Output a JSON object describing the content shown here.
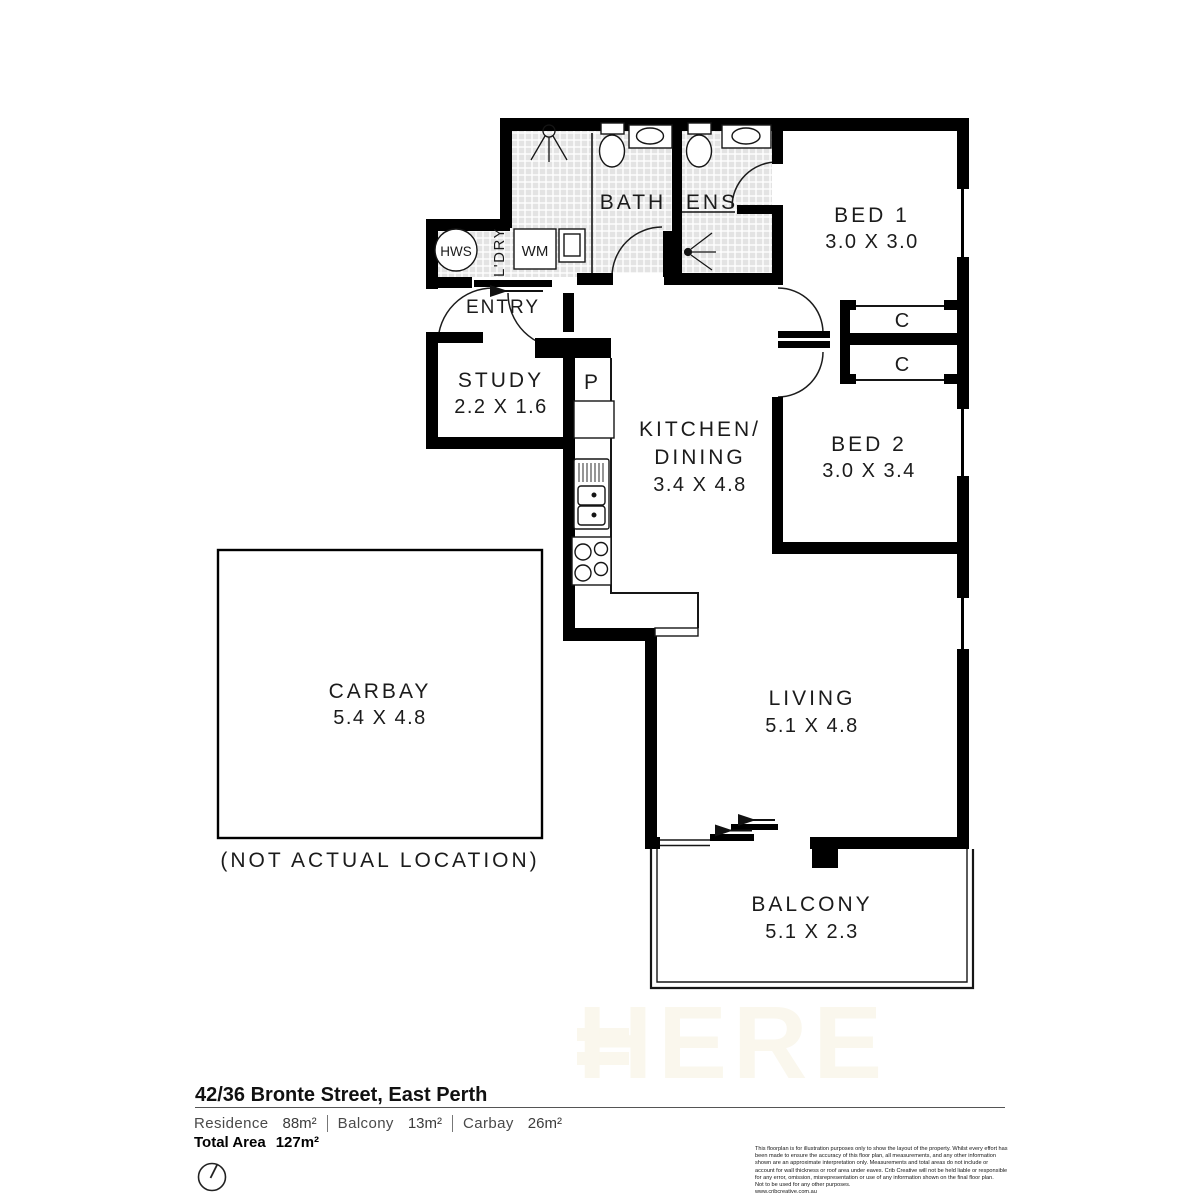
{
  "watermark": "HERE",
  "rooms": {
    "bath": {
      "label": "BATH"
    },
    "ens": {
      "label": "ENS"
    },
    "bed1": {
      "label": "BED 1",
      "dims": "3.0 X 3.0"
    },
    "bed2": {
      "label": "BED 2",
      "dims": "3.0 X 3.4"
    },
    "study": {
      "label": "STUDY",
      "dims": "2.2 X 1.6"
    },
    "kitchen": {
      "label": "KITCHEN/",
      "label2": "DINING",
      "dims": "3.4 X 4.8"
    },
    "living": {
      "label": "LIVING",
      "dims": "5.1 X 4.8"
    },
    "balcony": {
      "label": "BALCONY",
      "dims": "5.1 X 2.3"
    },
    "carbay": {
      "label": "CARBAY",
      "dims": "5.4 X 4.8",
      "note": "(NOT ACTUAL LOCATION)"
    },
    "entry": {
      "label": "ENTRY"
    },
    "laundry": {
      "label": "L'DRY"
    }
  },
  "fixtures": {
    "hws": "HWS",
    "wm": "WM",
    "pantry": "P",
    "closet1": "C",
    "closet2": "C"
  },
  "footer": {
    "address": "42/36 Bronte Street, East Perth",
    "specs": [
      {
        "label": "Residence",
        "value": "88m²"
      },
      {
        "label": "Balcony",
        "value": "13m²"
      },
      {
        "label": "Carbay",
        "value": "26m²"
      }
    ],
    "total_label": "Total Area",
    "total_value": "127m²",
    "disclaimer": [
      "This floorplan is for illustration purposes only to show the layout of the property. Whilst every effort has",
      "been made to ensure the accuracy of this floor plan, all measurements, and any other information",
      "shown are an approximate interpretation only. Measurements and total areas do not include or",
      "account for wall thickness or roof area under eaves. Crib Creative will not be held liable or responsible",
      "for any error, omission, misrepresentation or use of any information shown on the final floor plan.",
      "Not to be used for any other purposes.",
      "www.cribcreative.com.au"
    ]
  }
}
